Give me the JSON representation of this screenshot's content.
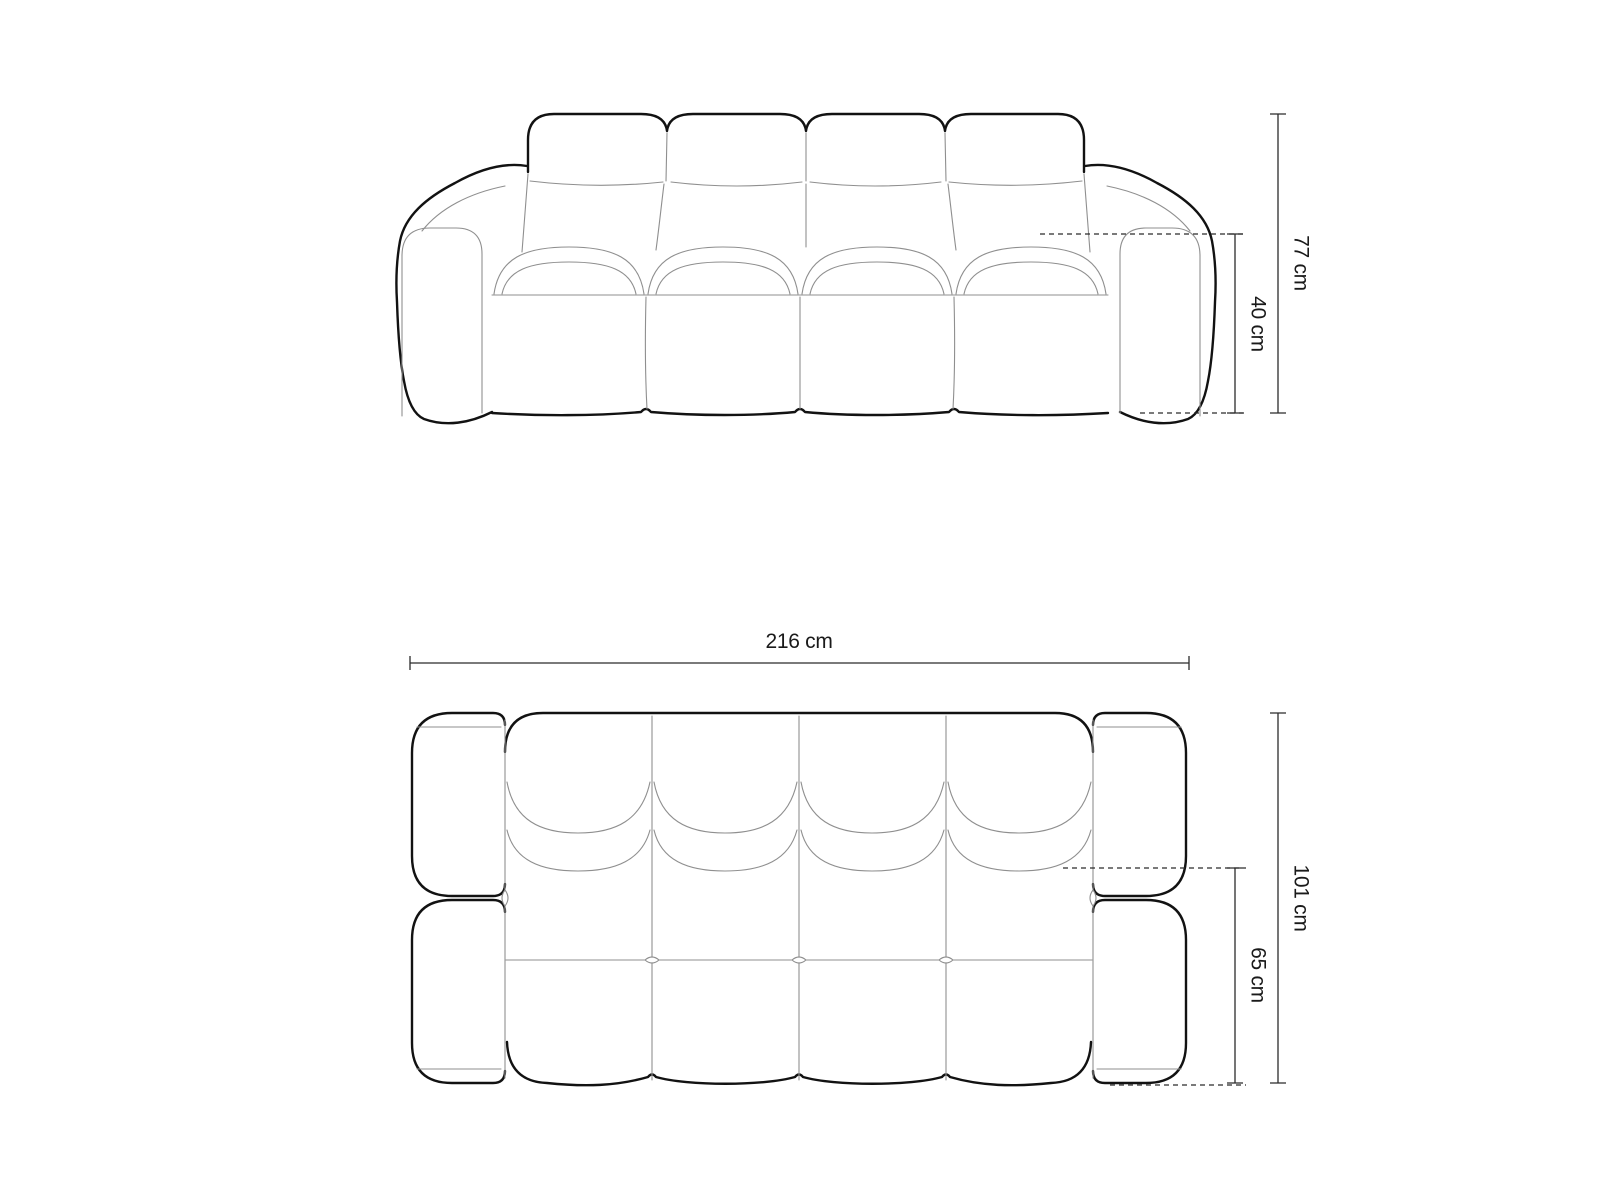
{
  "diagram": {
    "background": "#ffffff",
    "colors": {
      "outline": "#121212",
      "seam": "#8f8f8f",
      "dimension": "#2b2b2b",
      "text": "#1a1a1a"
    },
    "front_view": {
      "dimensions": {
        "total_height": "77 cm",
        "seat_height": "40 cm"
      }
    },
    "top_view": {
      "dimensions": {
        "total_width": "216 cm",
        "total_depth": "101 cm",
        "seat_depth": "65 cm"
      }
    }
  }
}
